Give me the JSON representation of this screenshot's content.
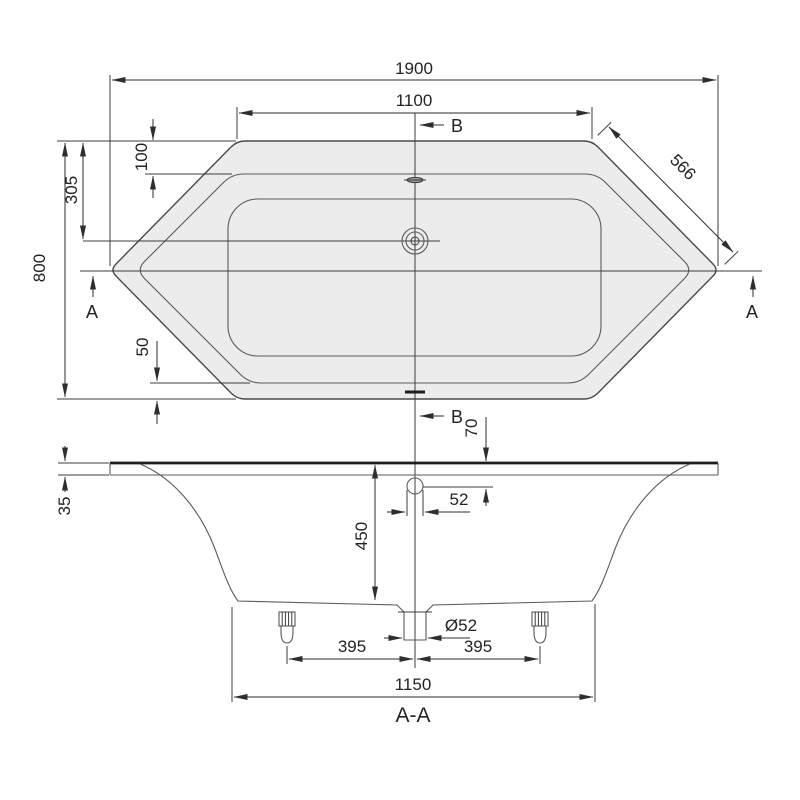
{
  "drawing_type": "bathtub technical drawing (hexagonal tub, plan + section)",
  "top_view": {
    "overall_length": "1900",
    "top_edge_length": "1100",
    "overall_width": "800",
    "diagonal_edge": "566",
    "drain_offset_from_top": "305",
    "rim_width_top": "100",
    "rim_width_bottom": "50",
    "marker_b_top": "B",
    "marker_b_bottom": "B",
    "marker_a_left": "A",
    "marker_a_right": "A"
  },
  "section_view": {
    "title": "A-A",
    "rim_thickness": "35",
    "overflow_offset_from_rim": "70",
    "overflow_width": "52",
    "inner_depth": "450",
    "drain_diameter": "Ø52",
    "foot_offset_left": "395",
    "foot_offset_right": "395",
    "bottom_length": "1150"
  },
  "colors": {
    "line": "#3c3c3c",
    "tub_fill": "#ececec",
    "text": "#232323",
    "background": "#ffffff"
  }
}
